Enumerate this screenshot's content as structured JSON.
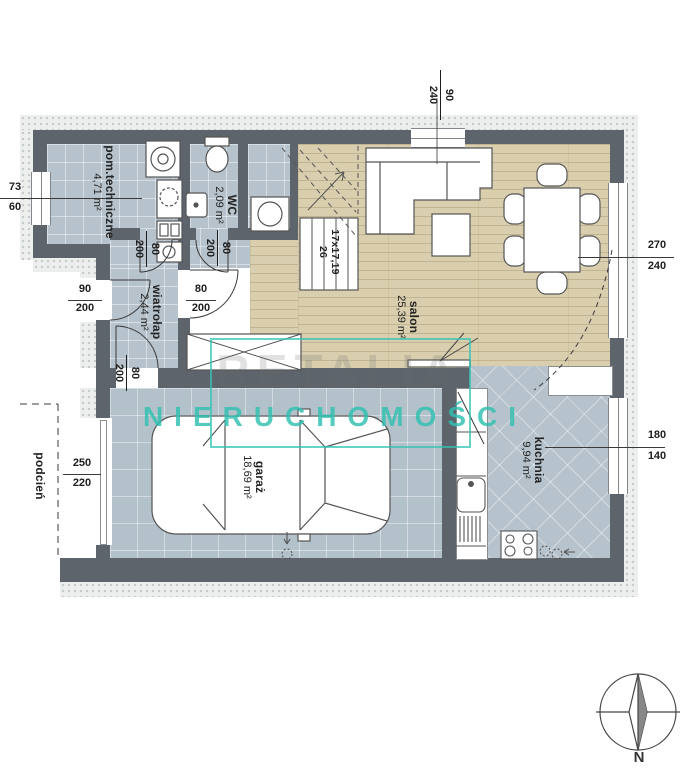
{
  "rooms": {
    "pom": {
      "name": "pom.techniczne",
      "area": "4,71 m²"
    },
    "wc": {
      "name": "WC",
      "area": "2,09 m²"
    },
    "wiatrolap": {
      "name": "wiatrołap",
      "area": "2,44 m²"
    },
    "salon": {
      "name": "salon",
      "area": "25,39 m²"
    },
    "garaz": {
      "name": "garaż",
      "area": "18,69 m²"
    },
    "kuchnia": {
      "name": "kuchnia",
      "area": "9,94 m²"
    },
    "podcien": {
      "name": "podcień"
    }
  },
  "stairs": {
    "line1": "17x17,19",
    "line2": "26"
  },
  "dims": {
    "top_window": {
      "a": "90",
      "b": "240"
    },
    "left_window": {
      "a": "73",
      "b": "60"
    },
    "salon_door": {
      "a": "270",
      "b": "240"
    },
    "kitchen_window": {
      "a": "180",
      "b": "140"
    },
    "garage_door": {
      "a": "250",
      "b": "220"
    },
    "entry_door": {
      "a": "90",
      "b": "200"
    },
    "door_pom": {
      "a": "80",
      "b": "200"
    },
    "door_wc": {
      "a": "80",
      "b": "200"
    },
    "door_salon": {
      "a": "80",
      "b": "200"
    },
    "door_garaz": {
      "a": "80",
      "b": "200"
    }
  },
  "watermark": {
    "brand": "RETALIA",
    "caption": "NIERUCHOMOŚCI"
  },
  "compass": {
    "north": "N"
  },
  "colors": {
    "wall": "#5d646b",
    "tile": "#b6c3cc",
    "wood": "#d9cfae",
    "accent": "#30c0b1"
  }
}
